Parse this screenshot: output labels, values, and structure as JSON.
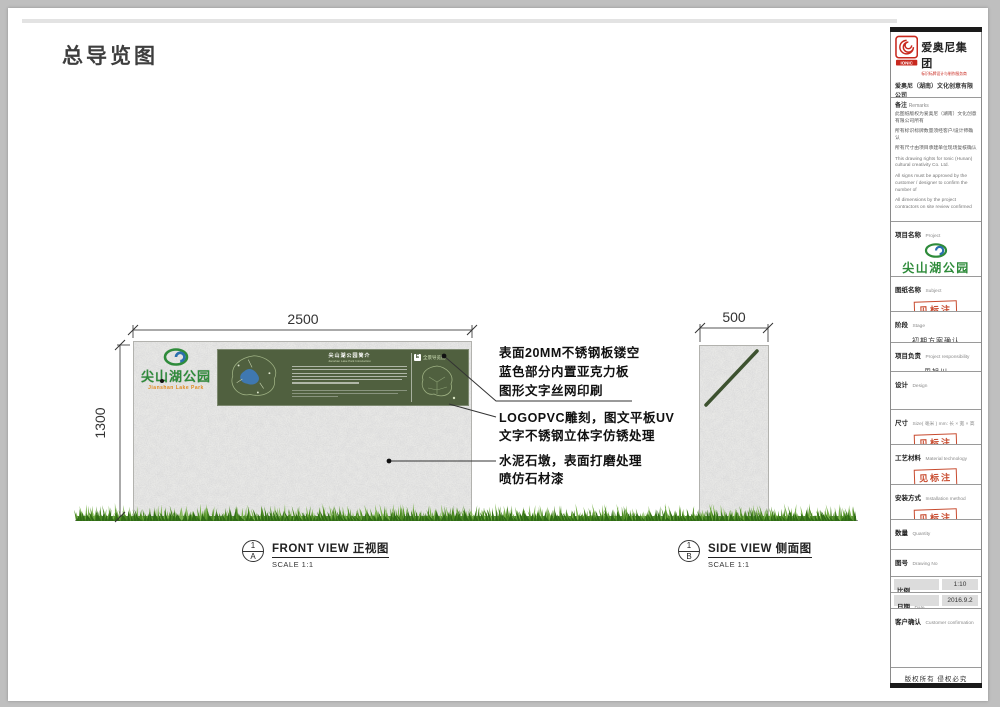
{
  "page": {
    "title": "总导览图"
  },
  "company": {
    "logo": "IONIC",
    "group_name": "爱奥尼集团",
    "tagline": "标识标牌设计与制作服务商",
    "full_name": "爱奥尼（湖南）文化创意有限公司",
    "address": "地址:长沙市梅溪湖西路商业国际2122座",
    "phone": "电话:0731-85074045",
    "website": "http://www.ionic.net.cn"
  },
  "remarks": {
    "label_zh": "备注",
    "label_en": "Remarks",
    "zh_lines": [
      "此图纸版权为爱奥尼（湖南）文化创意有限公司所有",
      "所有标识标牌数量须经客户/设计师确认",
      "所有尺寸由项目承建单位现场复核确认"
    ],
    "en_lines": [
      "This drawing rights for Ionic (Hunan) cultural creativity Co. Ltd.",
      "All signs must be approved by the customer / designer to confirm the number of",
      "All dimensions by the project contractors on site review confirmed"
    ]
  },
  "titleblock": {
    "stamp": "见标注",
    "copyright": "版权所有 侵权必究",
    "sections": {
      "project": {
        "zh": "项目名称",
        "en": "Project",
        "park_name": "尖山湖公园",
        "park_name_en": "Jianshan Lake Park"
      },
      "subject": {
        "zh": "图纸名称",
        "en": "Subject"
      },
      "stage": {
        "zh": "阶段",
        "en": "Stage",
        "value": "初期方案确认"
      },
      "responsibility": {
        "zh": "项目负责",
        "en": "Project responsibility",
        "value": "周旭川"
      },
      "design": {
        "zh": "设计",
        "en": "Design"
      },
      "size": {
        "zh": "尺寸",
        "en": "Size( 毫米 ) mm: 长 × 宽 × 高"
      },
      "material": {
        "zh": "工艺材料",
        "en": "Material technology"
      },
      "installation": {
        "zh": "安装方式",
        "en": "Installation method"
      },
      "quantity": {
        "zh": "数量",
        "en": "Quantity"
      },
      "drawing_no": {
        "zh": "图号",
        "en": "Drawing No"
      },
      "proportion": {
        "zh": "比例",
        "en": "Proportion",
        "value": "1:10"
      },
      "date": {
        "zh": "日期",
        "en": "Date",
        "value": "2016.9.2"
      },
      "customer": {
        "zh": "客户确认",
        "en": "Customer confirmation"
      }
    }
  },
  "drawing": {
    "front_view": {
      "title": "FRONT VIEW 正视图",
      "scale": "SCALE 1:1",
      "ref_no": "1",
      "ref_letter": "A",
      "dim_width": "2500",
      "dim_height": "1300"
    },
    "side_view": {
      "title": "SIDE VIEW 侧面图",
      "scale": "SCALE 1:1",
      "ref_no": "1",
      "ref_letter": "B",
      "dim_width": "500"
    },
    "sign": {
      "park_name": "尖山湖公园",
      "park_name_en": "Jianshan Lake Park",
      "panel_title": "尖山湖公园简介",
      "panel_subtitle": "Jianshan Lake Park Introduction",
      "corner_letter": "E",
      "corner_label": "全景导览图"
    },
    "annotations": {
      "a1_l1": "表面20MM不锈钢板镂空",
      "a1_l2": "蓝色部分内置亚克力板",
      "a1_l3": "图形文字丝网印刷",
      "a2_l1": "LOGOPVC雕刻，图文平板UV",
      "a2_l2": "文字不锈钢立体字仿锈处理",
      "a3_l1": "水泥石墩，表面打磨处理",
      "a3_l2": "喷仿石材漆"
    }
  }
}
